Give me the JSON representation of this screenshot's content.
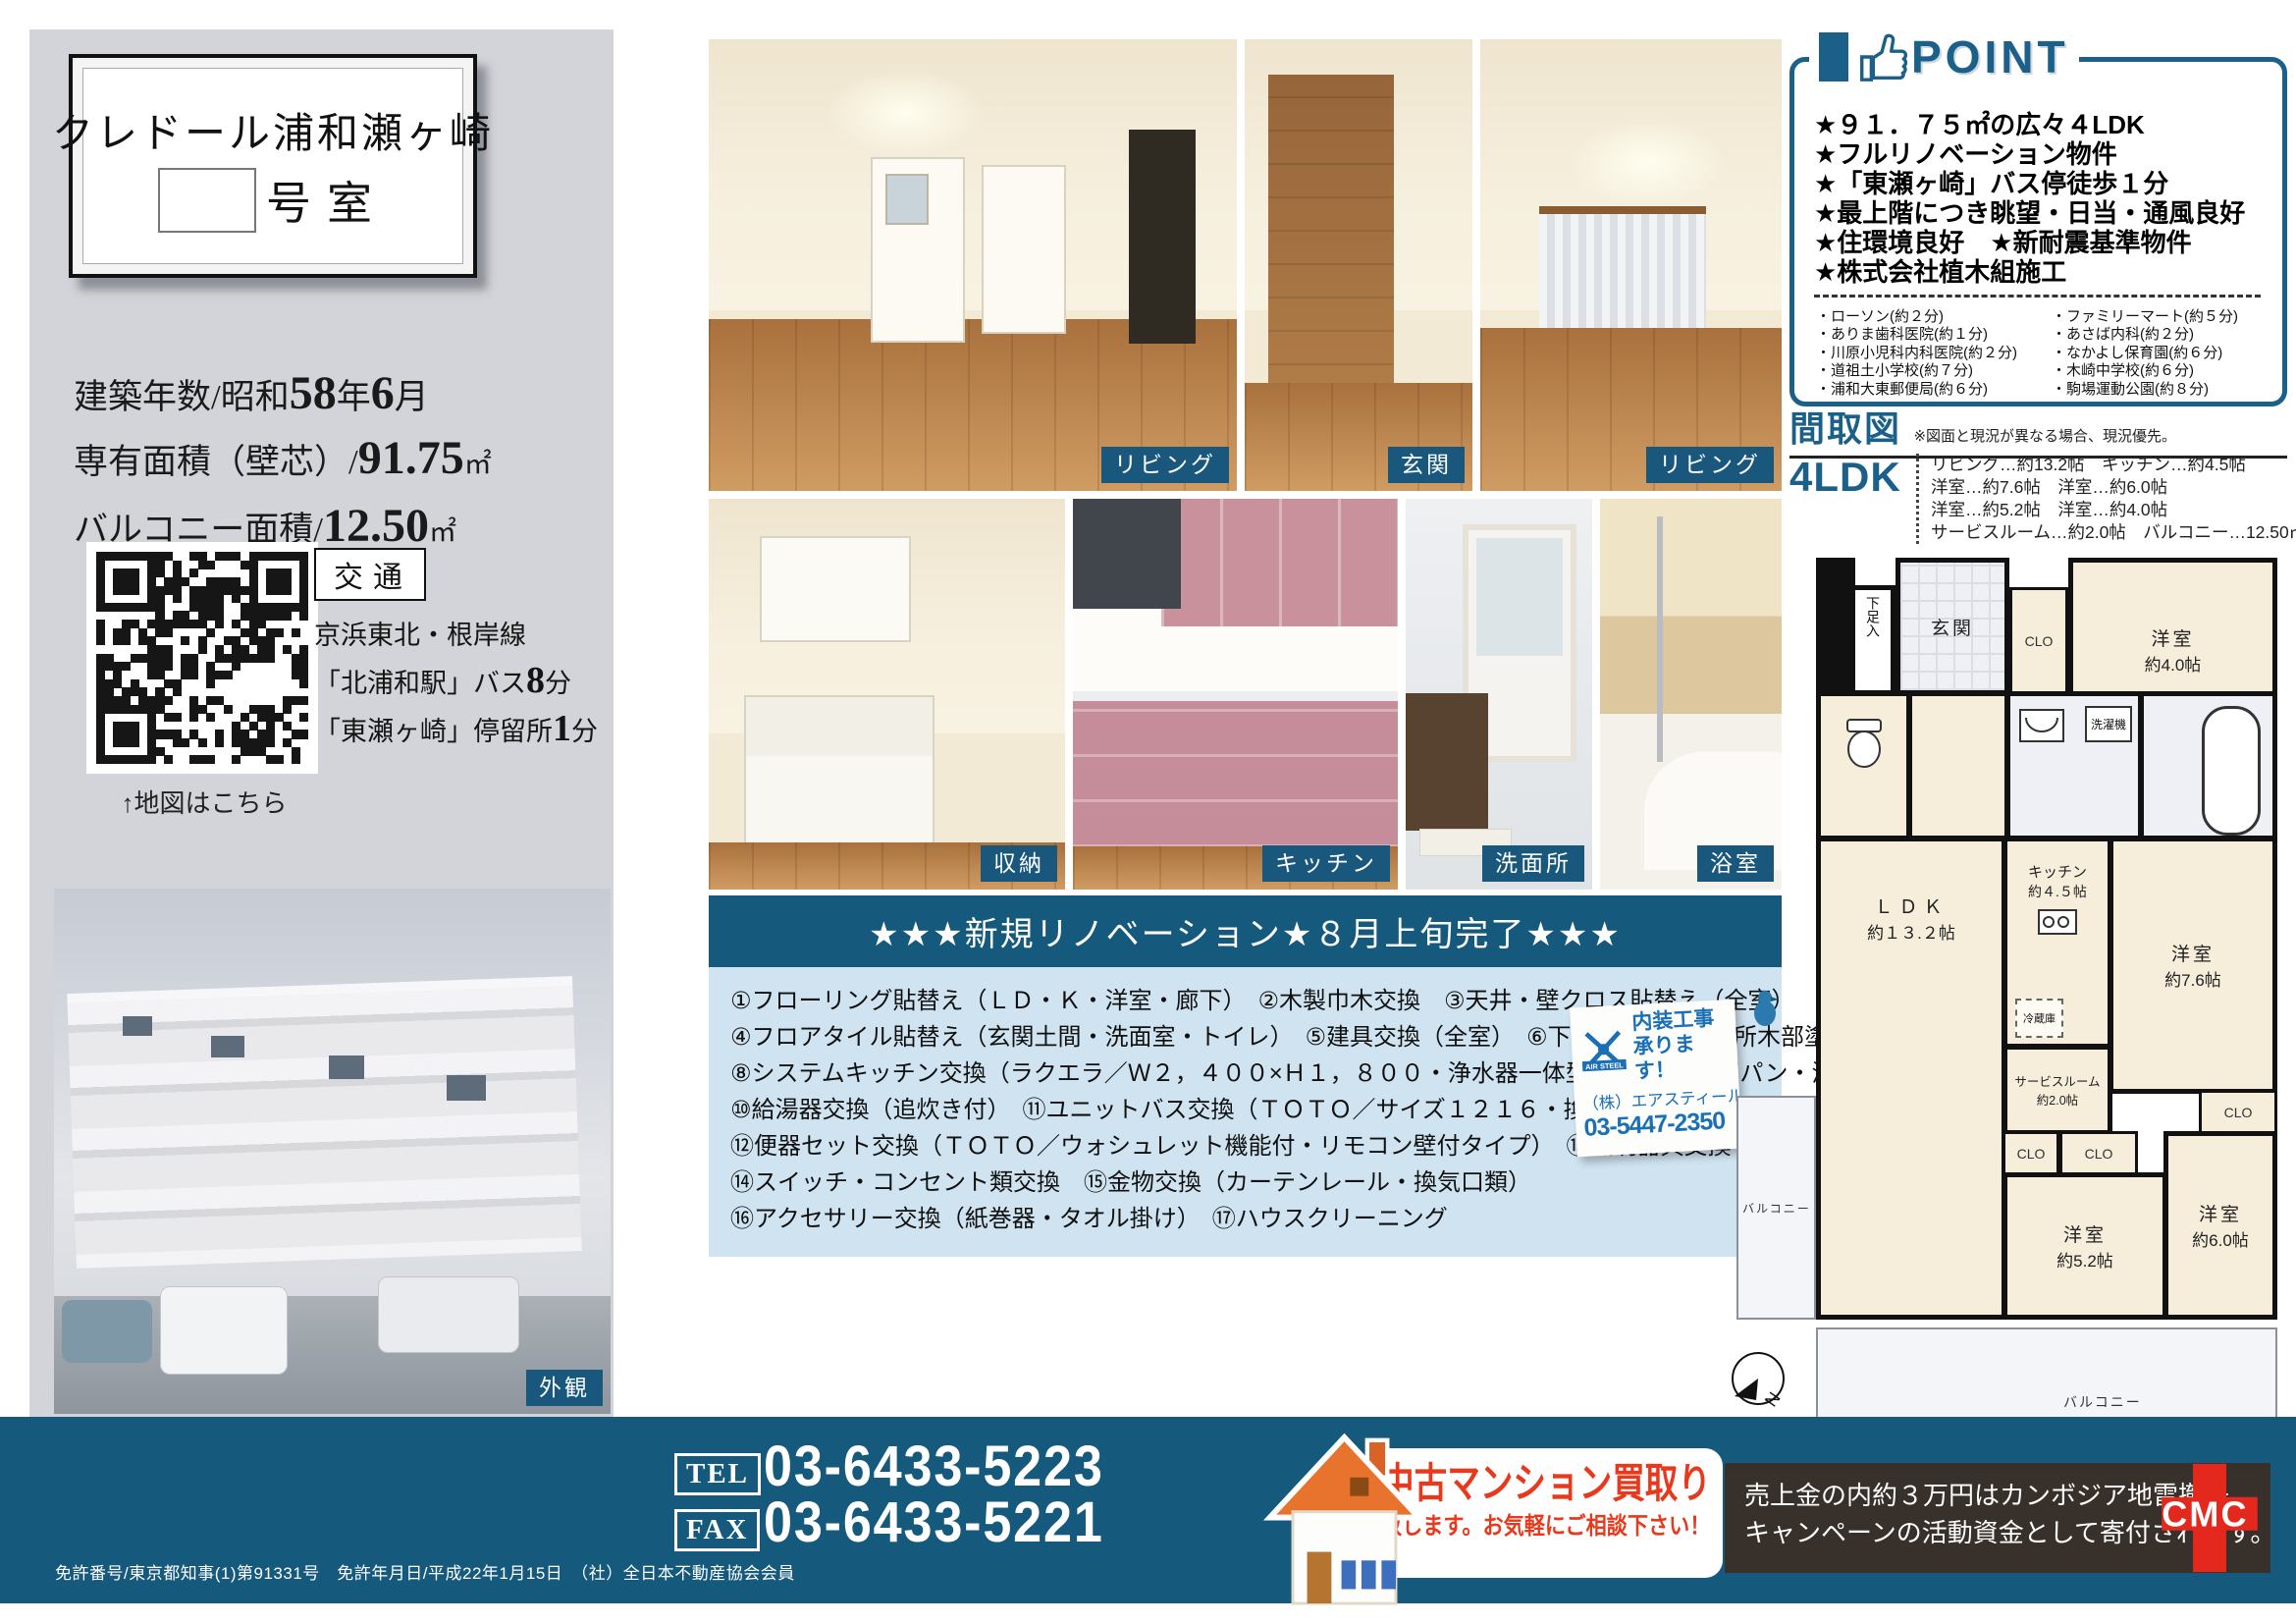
{
  "title_card": {
    "building_name": "クレドール浦和瀬ヶ崎",
    "room_suffix": "号室"
  },
  "property": {
    "built_label": "建築年数/昭和",
    "built_year": "58",
    "built_year_unit": "年",
    "built_month": "6",
    "built_month_unit": "月",
    "area_label": "専有面積（壁芯）/",
    "area_value": "91.75",
    "area_unit": "㎡",
    "balcony_label": "バルコニー面積/",
    "balcony_value": "12.50",
    "balcony_unit": "㎡"
  },
  "access": {
    "heading": "交通",
    "line1": "京浜東北・根岸線",
    "station_pre": "「北浦和駅」バス",
    "station_num": "8",
    "station_suf": "分",
    "stop_pre": "「東瀬ヶ崎」停留所",
    "stop_num": "1",
    "stop_suf": "分",
    "qr_caption": "↑地図はこちら"
  },
  "photos": {
    "top": [
      {
        "label": "リビング"
      },
      {
        "label": "玄関"
      },
      {
        "label": "リビング"
      }
    ],
    "bottom": [
      {
        "label": "収納"
      },
      {
        "label": "キッチン"
      },
      {
        "label": "洗面所"
      },
      {
        "label": "浴室"
      }
    ],
    "exterior_label": "外観"
  },
  "point": {
    "header": "POINT",
    "items": [
      "★９１．７５㎡の広々４LDK",
      "★フルリノベーション物件",
      "★「東瀬ヶ崎」バス停徒歩１分",
      "★最上階につき眺望・日当・通風良好",
      "★住環境良好　★新耐震基準物件",
      "★株式会社植木組施工"
    ],
    "facilities_left": [
      "・ローソン(約２分)",
      "・ありま歯科医院(約１分)",
      "・川原小児科内科医院(約２分)",
      "・道祖土小学校(約７分)",
      "・浦和大東郵便局(約６分)"
    ],
    "facilities_right": [
      "・ファミリーマート(約５分)",
      "・あさば内科(約２分)",
      "・なかよし保育園(約６分)",
      "・木崎中学校(約６分)",
      "・駒場運動公園(約８分)"
    ]
  },
  "madori": {
    "heading": "間取図",
    "note": "※図面と現況が異なる場合、現況優先。",
    "type": "4LDK",
    "rooms": [
      "リビング…約13.2帖　キッチン…約4.5帖",
      "洋室…約7.6帖　洋室…約6.0帖",
      "洋室…約5.2帖　洋室…約4.0帖",
      "サービスルーム…約2.0帖　バルコニー…12.50㎡"
    ]
  },
  "floorplan": {
    "genkan": "玄関",
    "shoe": "下足入",
    "clo": "CLO",
    "room40_name": "洋室",
    "room40_size": "約4.0帖",
    "room76_name": "洋室",
    "room76_size": "約7.6帖",
    "room52_name": "洋室",
    "room52_size": "約5.2帖",
    "room60_name": "洋室",
    "room60_size": "約6.0帖",
    "ldk_name": "ＬＤＫ",
    "ldk_size": "約１３.２帖",
    "kitchen_name": "キッチン",
    "kitchen_size": "約４.５帖",
    "service_name": "サービスルーム",
    "service_size": "約2.0帖",
    "fridge": "冷蔵庫",
    "washer": "洗濯機",
    "balcony_left": "バルコニー",
    "balcony_bottom": "バルコニー",
    "hatch": "避難ハッチ",
    "north": "N"
  },
  "renovation": {
    "title": "★★★新規リノベーション★８月上旬完了★★★",
    "lines": [
      "①フローリング貼替え（ＬＤ・Ｋ・洋室・廊下）　②木製巾木交換　③天井・壁クロス貼替え（全室）",
      "④フロアタイル貼替え（玄関土間・洗面室・トイレ）　⑤建具交換（全室）　⑥下足入交換　⑦各所木部塗装",
      "⑧システムキッチン交換（ラクエラ／Ｗ２，４００×Ｈ１，８００・浄水器一体型水栓）　⑨洗濯パン・洗濯水栓交換",
      "⑩給湯器交換（追炊き付）　⑪ユニットバス交換（ＴＯＴＯ／サイズ１２１６・換気乾燥暖房機付）",
      "⑫便器セット交換（ＴＯＴＯ／ウォシュレット機能付・リモコン壁付タイプ）　⑬照明器具交換",
      "⑭スイッチ・コンセント類交換　⑮金物交換（カーテンレール・換気口類）",
      "⑯アクセサリー交換（紙巻器・タオル掛け）　⑰ハウスクリーニング"
    ]
  },
  "airsteel": {
    "brand": "AIR STEEL",
    "line1": "内装工事",
    "line2": "承ります！",
    "company": "（株）エアスティール",
    "phone": "03-5447-2350"
  },
  "footer": {
    "tel_label": "TEL",
    "tel": "03-6433-5223",
    "fax_label": "FAX",
    "fax": "03-6433-5221",
    "banner_main": "中古マンション買取り",
    "banner_sub": "致します。お気軽にご相談下さい！",
    "cmc_line1": "売上金の内約３万円はカンボジア地雷撤去",
    "cmc_line2": "キャンペーンの活動資金として寄付されます。",
    "cmc_logo": "CMC",
    "license": "免許番号/東京都知事(1)第91331号　免許年月日/平成22年1月15日　（社）全日本不動産協会会員"
  },
  "colors": {
    "accent_teal": "#15597c",
    "point_teal": "#1a6089",
    "reno_body": "#cfe3f0",
    "red": "#e8391c",
    "cream": "#f6eddb",
    "cmc_bg": "#38302a",
    "cmc_red": "#e5281e",
    "gray_panel": "#d2d4d9"
  }
}
